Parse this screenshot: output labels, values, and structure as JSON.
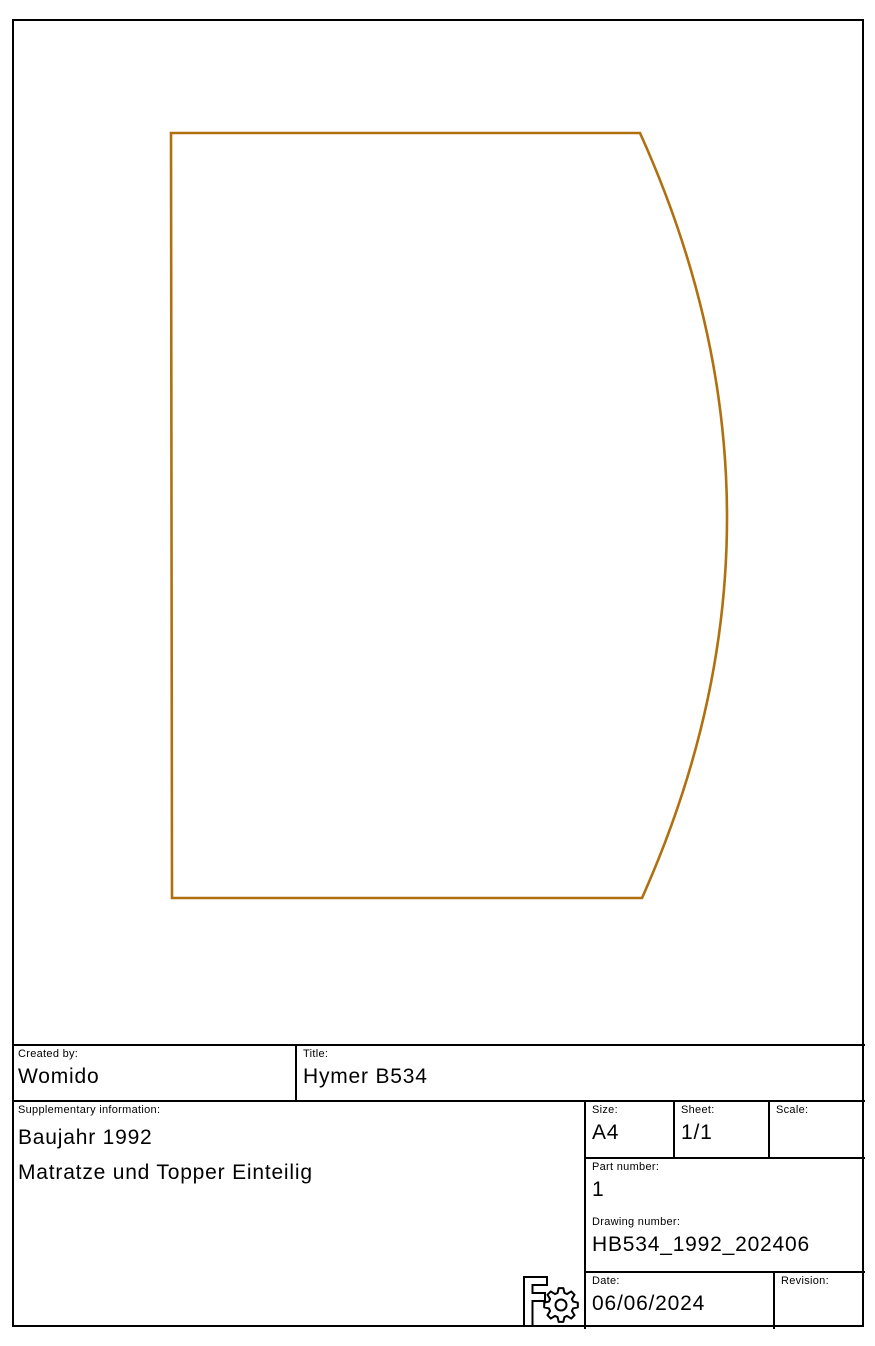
{
  "drawing": {
    "description": "mattress outline with straight left edge and bulged right edge",
    "line_color": "#b0700f"
  },
  "title_block": {
    "created_by": {
      "label": "Created by:",
      "value": "Womido"
    },
    "title": {
      "label": "Title:",
      "value": "Hymer B534"
    },
    "supplementary": {
      "label": "Supplementary information:",
      "lines": [
        "Baujahr 1992",
        "Matratze und Topper Einteilig"
      ]
    },
    "size": {
      "label": "Size:",
      "value": "A4"
    },
    "sheet": {
      "label": "Sheet:",
      "value": "1/1"
    },
    "scale": {
      "label": "Scale:",
      "value": ""
    },
    "part_number": {
      "label": "Part number:",
      "value": "1"
    },
    "drawing_number": {
      "label": "Drawing number:",
      "value": "HB534_1992_202406"
    },
    "date": {
      "label": "Date:",
      "value": "06/06/2024"
    },
    "revision": {
      "label": "Revision:",
      "value": ""
    }
  },
  "logo": {
    "name": "freecad-logo"
  }
}
